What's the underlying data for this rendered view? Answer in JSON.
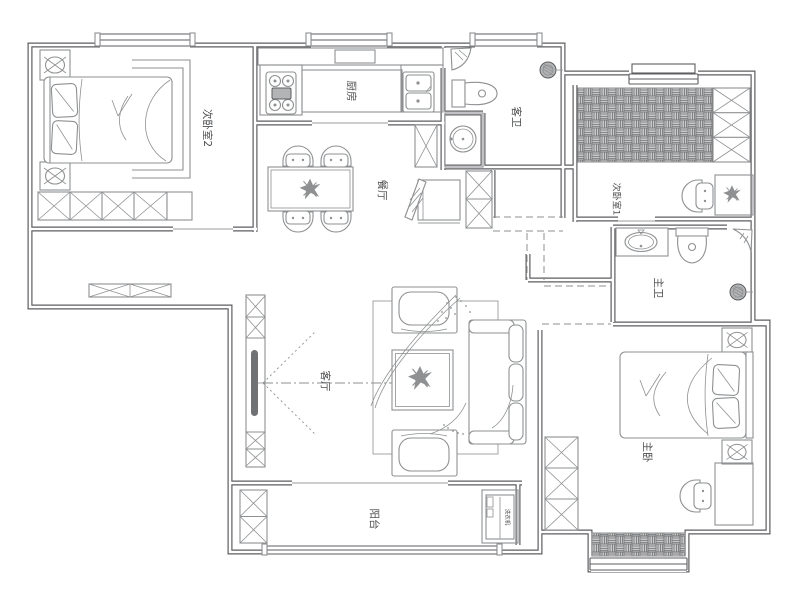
{
  "plan": {
    "colors": {
      "wall": "#5d5e60",
      "furniture": "#8e9092",
      "text": "#4d4e50",
      "hatch_fill": "#c9c9c9",
      "hatch_line": "#707274",
      "page_background": "#ffffff"
    },
    "rooms": [
      {
        "id": "bedroom-2",
        "label": "次卧室2"
      },
      {
        "id": "kitchen",
        "label": "厨房"
      },
      {
        "id": "dining-room",
        "label": "餐厅"
      },
      {
        "id": "guest-bathroom",
        "label": "客卫"
      },
      {
        "id": "bedroom-1",
        "label": "次卧室1"
      },
      {
        "id": "master-bathroom",
        "label": "主卫"
      },
      {
        "id": "living-room",
        "label": "客厅"
      },
      {
        "id": "master-bedroom",
        "label": "主卧"
      },
      {
        "id": "balcony",
        "label": "阳台"
      }
    ],
    "appliances": {
      "washing_machine": "洗衣机"
    }
  }
}
